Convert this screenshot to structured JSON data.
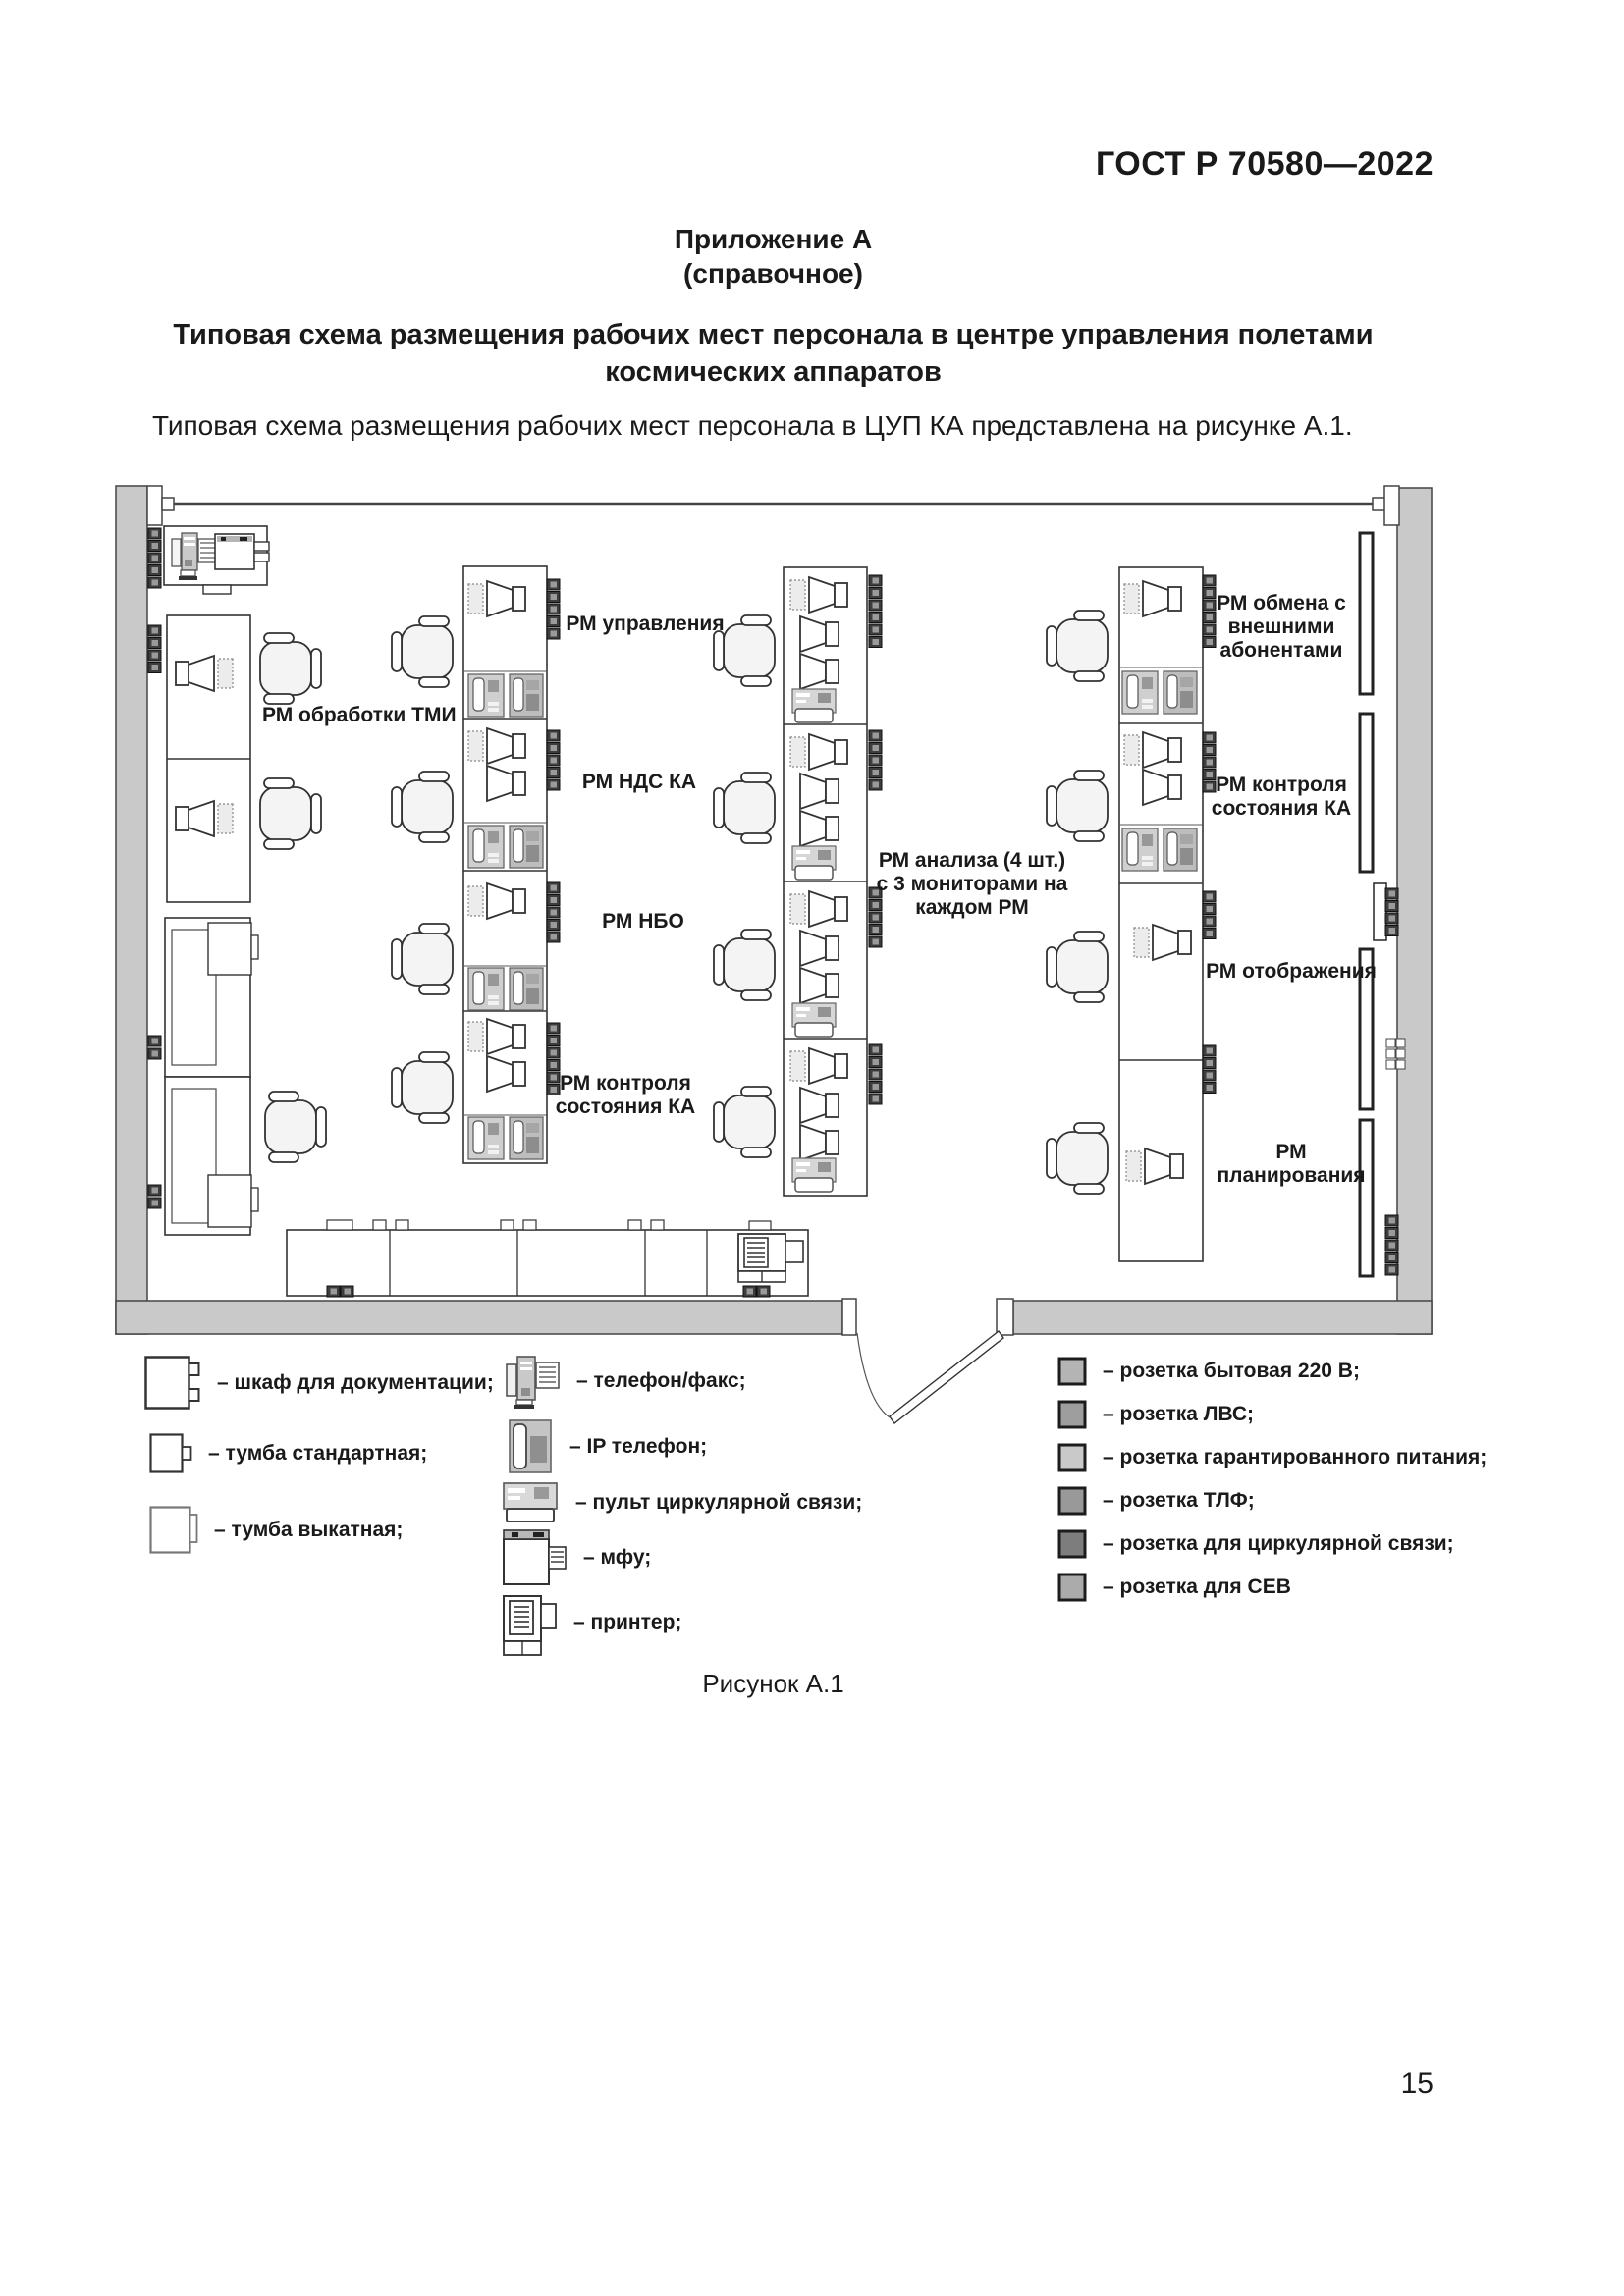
{
  "page": {
    "standard": "ГОСТ Р 70580—2022",
    "number": "15"
  },
  "annex": {
    "title": "Приложение А",
    "subtitle": "(справочное)"
  },
  "heading": {
    "line1": "Типовая схема размещения рабочих мест персонала в центре управления полетами",
    "line2": "космических аппаратов"
  },
  "intro": "Типовая схема размещения рабочих мест персонала в ЦУП КА представлена на рисунке А.1.",
  "figure": {
    "caption": "Рисунок А.1"
  },
  "plan": {
    "labels": {
      "tmi": "РМ обработки ТМИ",
      "upravleniya": "РМ управления",
      "nds_ka": "РМ НДС КА",
      "nbo": "РМ НБО",
      "kontrolya_l1": "РМ контроля",
      "kontrolya_l2": "состояния КА",
      "analiza_l1": "РМ анализа (4 шт.)",
      "analiza_l2": "с 3 мониторами на",
      "analiza_l3": "каждом РМ",
      "obmena_l1": "РМ обмена с",
      "obmena_l2": "внешними",
      "obmena_l3": "абонентами",
      "kontrolya_r1": "РМ контроля",
      "kontrolya_r2": "состояния КА",
      "otobrazheniya": "РМ отображения",
      "planirovaniya_l1": "РМ",
      "planirovaniya_l2": "планирования"
    }
  },
  "legend": {
    "furniture": [
      {
        "label": "– шкаф для документации;"
      },
      {
        "label": "– тумба стандартная;"
      },
      {
        "label": "– тумба выкатная;"
      }
    ],
    "devices": [
      {
        "label": "– телефон/факс;"
      },
      {
        "label": "– IP телефон;"
      },
      {
        "label": "– пульт циркулярной связи;"
      },
      {
        "label": "– мфу;"
      },
      {
        "label": "– принтер;"
      }
    ],
    "sockets": [
      {
        "label": "– розетка бытовая 220 В;",
        "color": "#b4b4b4"
      },
      {
        "label": "– розетка ЛВС;",
        "color": "#9e9e9e"
      },
      {
        "label": "– розетка гарантированного питания;",
        "color": "#c9c9c9"
      },
      {
        "label": "– розетка ТЛФ;",
        "color": "#999999"
      },
      {
        "label": "– розетка для циркулярной связи;",
        "color": "#7d7d7d"
      },
      {
        "label": "– розетка для СЕВ",
        "color": "#ababab"
      }
    ]
  }
}
